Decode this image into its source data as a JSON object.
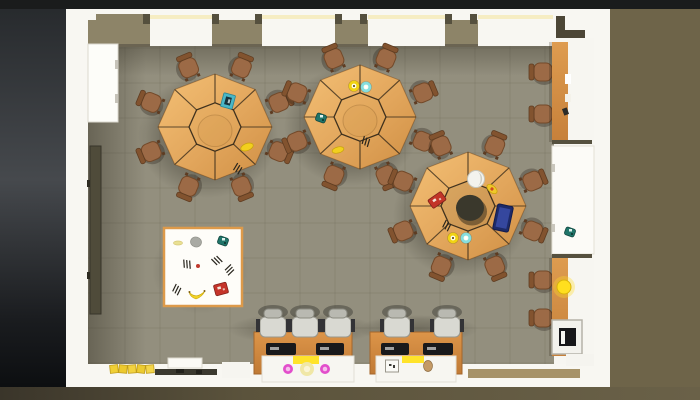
{
  "scene": {
    "canvas": {
      "w": 700,
      "h": 400
    },
    "chairAngles": [
      22.5,
      67.5,
      112.5,
      157.5,
      202.5,
      247.5,
      292.5,
      337.5
    ],
    "bg": [
      {
        "t": "rect",
        "n": "outside-ground-right",
        "x": 0,
        "y": 0,
        "w": 700,
        "h": 400,
        "f": "#6e6449"
      },
      {
        "t": "rect",
        "n": "outside-shadow-left",
        "x": 0,
        "y": 0,
        "w": 66,
        "h": 400,
        "f": "g:left"
      },
      {
        "t": "rect",
        "n": "top-dark-band",
        "x": 0,
        "y": 0,
        "w": 700,
        "h": 9,
        "f": "#1a1c1c"
      },
      {
        "t": "rect",
        "n": "bottom-ground-band",
        "x": 0,
        "y": 387,
        "w": 700,
        "h": 13,
        "f": "g:bottom"
      }
    ],
    "room": [
      {
        "t": "rect",
        "n": "room-walls",
        "x": 66,
        "y": 9,
        "w": 544,
        "h": 378,
        "f": "#f8f7f2"
      },
      {
        "t": "rect",
        "n": "floor",
        "x": 88,
        "y": 46,
        "w": 466,
        "h": 318,
        "f": "#938f7e"
      },
      {
        "t": "rect",
        "n": "right-worktop",
        "x": 554,
        "y": 38,
        "w": 40,
        "h": 326,
        "f": "#f7f6f1"
      }
    ],
    "grid": {
      "xs": [
        125,
        160,
        195,
        230,
        265,
        300,
        335,
        370,
        405,
        440,
        475,
        510,
        545
      ],
      "ys": [
        48,
        83,
        118,
        153,
        188,
        223,
        258,
        293,
        328,
        363
      ],
      "x0": 88,
      "x1": 554,
      "y0": 46,
      "y1": 364,
      "stroke": "#7e7a6a",
      "op": 0.5
    },
    "shadows": [
      {
        "t": "rect",
        "n": "floor-shadow-left",
        "x": 88,
        "y": 46,
        "w": 58,
        "h": 318,
        "f": "g:leftShadow"
      },
      {
        "t": "rect",
        "n": "floor-shadow-top",
        "x": 88,
        "y": 46,
        "w": 466,
        "h": 30,
        "f": "g:topShadow"
      },
      {
        "t": "ell",
        "n": "table-shadow",
        "x": 208,
        "y": 136,
        "rx": 70,
        "ry": 62,
        "f": "g:rad"
      },
      {
        "t": "ell",
        "n": "table-shadow",
        "x": 352,
        "y": 126,
        "rx": 68,
        "ry": 60,
        "f": "g:rad"
      },
      {
        "t": "ell",
        "n": "table-shadow",
        "x": 461,
        "y": 215,
        "rx": 68,
        "ry": 62,
        "f": "g:rad"
      },
      {
        "t": "ell",
        "n": "mat-shadow",
        "x": 200,
        "y": 270,
        "rx": 48,
        "ry": 44,
        "f": "g:rad",
        "op": 0.5
      },
      {
        "t": "ell",
        "n": "desk-shadow",
        "x": 302,
        "y": 329,
        "rx": 74,
        "ry": 16,
        "f": "g:rad",
        "op": 0.6
      },
      {
        "t": "ell",
        "n": "desk-shadow",
        "x": 418,
        "y": 329,
        "rx": 60,
        "ry": 14,
        "f": "g:rad",
        "op": 0.6
      }
    ],
    "topWall": {
      "sunColor": "#f6edc3",
      "chunkColor": "#8d8468",
      "edgeColor": "#6b6452",
      "notchColor": "#55503e",
      "cornerColor": "#4c4636",
      "windows": [
        {
          "x": 150,
          "w": 62
        },
        {
          "x": 262,
          "w": 73
        },
        {
          "x": 368,
          "w": 77
        },
        {
          "x": 478,
          "w": 75
        }
      ],
      "chunks": [
        {
          "x": 88,
          "w": 62
        },
        {
          "x": 212,
          "w": 50
        },
        {
          "x": 335,
          "w": 33
        },
        {
          "x": 445,
          "w": 33
        }
      ],
      "notches": [
        143,
        212,
        255,
        335,
        360,
        445,
        470
      ],
      "step": {
        "x": 96,
        "w": 47
      },
      "corner": [
        {
          "x": 556,
          "y": 16,
          "w": 9,
          "h": 22
        },
        {
          "x": 565,
          "y": 30,
          "w": 20,
          "h": 8
        }
      ]
    },
    "leftFixtures": [
      {
        "t": "rect",
        "n": "left-cabinet",
        "x": 88,
        "y": 44,
        "w": 30,
        "h": 78,
        "f": "#fdfdf9",
        "s": "#dcd9cf",
        "sw": 1
      },
      {
        "t": "rect",
        "n": "cabinet-handle",
        "x": 115,
        "y": 60,
        "w": 3,
        "h": 9,
        "f": "#c6c3b9"
      },
      {
        "t": "rect",
        "n": "cabinet-handle",
        "x": 115,
        "y": 94,
        "w": 3,
        "h": 9,
        "f": "#c6c3b9"
      },
      {
        "t": "rect",
        "n": "wall-board",
        "x": 90,
        "y": 146,
        "w": 11,
        "h": 168,
        "f": "#4f4b3a",
        "s": "#37342a",
        "sw": 1
      },
      {
        "t": "rect",
        "n": "board-bracket",
        "x": 87,
        "y": 180,
        "w": 3,
        "h": 7,
        "f": "#2e2c22"
      },
      {
        "t": "rect",
        "n": "board-bracket",
        "x": 87,
        "y": 272,
        "w": 3,
        "h": 7,
        "f": "#2e2c22"
      }
    ],
    "rightFixtures": [
      {
        "t": "rect",
        "n": "counter-edge-shadow",
        "x": 549,
        "y": 42,
        "w": 4,
        "h": 100,
        "f": "rgba(40,30,15,0.22)"
      },
      {
        "t": "rect",
        "n": "wood-counter-top",
        "x": 552,
        "y": 42,
        "w": 16,
        "h": 100,
        "f": "g:woodv"
      },
      {
        "t": "rect",
        "n": "counter-paper",
        "x": 565,
        "y": 74,
        "w": 6,
        "h": 10,
        "f": "#ffffff"
      },
      {
        "t": "rect",
        "n": "counter-paper",
        "x": 565,
        "y": 94,
        "w": 6,
        "h": 8,
        "f": "#f4f2ea"
      },
      {
        "t": "rect",
        "n": "counter-mouse",
        "x": 563,
        "y": 108,
        "w": 5,
        "h": 7,
        "f": "#2b2b28",
        "rot": -20
      },
      {
        "t": "rect",
        "n": "counter-divider",
        "x": 552,
        "y": 140,
        "w": 40,
        "h": 4,
        "f": "#56513f"
      },
      {
        "t": "rect",
        "n": "white-side-table",
        "x": 552,
        "y": 146,
        "w": 42,
        "h": 108,
        "f": "#fcfbf7",
        "s": "#e3e0d6",
        "sw": 1
      },
      {
        "t": "rect",
        "n": "side-table-handle",
        "x": 552,
        "y": 164,
        "w": 3,
        "h": 8,
        "f": "#c9c6bc"
      },
      {
        "t": "rect",
        "n": "side-table-handle",
        "x": 552,
        "y": 224,
        "w": 3,
        "h": 8,
        "f": "#c9c6bc"
      },
      {
        "t": "rect",
        "n": "counter-divider",
        "x": 552,
        "y": 254,
        "w": 40,
        "h": 4,
        "f": "#56513f"
      },
      {
        "t": "rect",
        "n": "counter-edge-shadow",
        "x": 549,
        "y": 258,
        "w": 4,
        "h": 98,
        "f": "rgba(40,30,15,0.22)"
      },
      {
        "t": "rect",
        "n": "wood-counter-bottom",
        "x": 552,
        "y": 258,
        "w": 16,
        "h": 98,
        "f": "g:woodv"
      },
      {
        "t": "circ",
        "n": "lamp-glow",
        "x": 564,
        "y": 287,
        "r": 11,
        "f": "rgba(255,222,40,0.35)"
      },
      {
        "t": "circ",
        "n": "desk-lamp",
        "x": 564,
        "y": 287,
        "r": 7,
        "f": "#ffdf1e",
        "s": "#d9b40a",
        "sw": 1
      },
      {
        "t": "rect",
        "n": "printer-body",
        "x": 552,
        "y": 320,
        "w": 30,
        "h": 34,
        "f": "#f3f2ed",
        "s": "#b5b2a8",
        "sw": 1.5
      },
      {
        "t": "rect",
        "n": "printer-screen",
        "x": 559,
        "y": 328,
        "w": 17,
        "h": 18,
        "f": "#17171a"
      },
      {
        "t": "rect",
        "n": "printer-slot",
        "x": 561,
        "y": 331,
        "w": 4,
        "h": 13,
        "f": "#f6f6f2"
      },
      {
        "t": "rect",
        "n": "corner-shelf",
        "x": 566,
        "y": 354,
        "w": 28,
        "h": 12,
        "f": "#f5f4ef"
      }
    ],
    "rightItems": [
      {
        "type": "clump",
        "x": 570,
        "y": 232
      }
    ],
    "mat": {
      "x": 164,
      "y": 228,
      "w": 78,
      "h": 78,
      "fill": "#fefdf9",
      "border": "#dd9a4a",
      "items": [
        {
          "type": "blob",
          "x": 178,
          "y": 243,
          "w": 9,
          "h": 4,
          "rot": 0,
          "f": "#e9e093",
          "s": "#d6c877"
        },
        {
          "type": "blob",
          "x": 196,
          "y": 242,
          "w": 11,
          "h": 10,
          "rot": 15,
          "f": "#a9aaa4",
          "s": "#8f9089"
        },
        {
          "type": "clump",
          "x": 223,
          "y": 241
        },
        {
          "type": "dot",
          "x": 198,
          "y": 266,
          "r": 2,
          "f": "#c03a2e"
        },
        {
          "type": "marks",
          "x": 176,
          "y": 289,
          "rot": 40
        },
        {
          "type": "marks",
          "x": 186,
          "y": 264,
          "rot": 10
        },
        {
          "type": "marks",
          "x": 216,
          "y": 261,
          "rot": -30
        },
        {
          "type": "marks",
          "x": 229,
          "y": 269,
          "rot": 60
        },
        {
          "type": "banana",
          "x": 197,
          "y": 291
        },
        {
          "type": "box",
          "x": 221,
          "y": 289,
          "w": 13,
          "h": 11,
          "rot": -15,
          "f": "#c5342a"
        }
      ]
    },
    "tables": [
      {
        "name": "octagon-table-1",
        "cx": 215,
        "cy": 127,
        "r": 57,
        "ir": 26,
        "hole": false,
        "items": [
          {
            "type": "book",
            "x": 228,
            "y": 101,
            "rot": 15
          },
          {
            "type": "blob",
            "x": 247,
            "y": 147,
            "w": 13,
            "h": 7,
            "rot": -20,
            "f": "#f2cf1e",
            "s": "#c7a30a"
          },
          {
            "type": "marks",
            "x": 237,
            "y": 168,
            "rot": 45
          }
        ]
      },
      {
        "name": "octagon-table-2",
        "cx": 360,
        "cy": 117,
        "r": 56,
        "ir": 26,
        "hole": false,
        "items": [
          {
            "type": "donut",
            "x": 354,
            "y": 86,
            "ring": "#f2d313",
            "dotc": "#6b5a12"
          },
          {
            "type": "donut",
            "x": 366,
            "y": 87,
            "ring": "#86dede",
            "dotc": "#ffffff"
          },
          {
            "type": "clump",
            "x": 321,
            "y": 118
          },
          {
            "type": "blob",
            "x": 338,
            "y": 150,
            "w": 12,
            "h": 6,
            "rot": -15,
            "f": "#f2cf1e",
            "s": "#c7a30a"
          },
          {
            "type": "marks",
            "x": 365,
            "y": 141,
            "rot": 30
          }
        ]
      },
      {
        "name": "octagon-donut-table",
        "cx": 468,
        "cy": 206,
        "r": 58,
        "ir": 27,
        "hole": true,
        "items": [
          {
            "type": "globe",
            "x": 476,
            "y": 179
          },
          {
            "type": "blob",
            "x": 492,
            "y": 189,
            "w": 12,
            "h": 7,
            "rot": 40,
            "f": "#f0c82a",
            "s": "#c7a30a",
            "dotc": "#d04a20"
          },
          {
            "type": "box",
            "x": 437,
            "y": 200,
            "w": 16,
            "h": 10,
            "rot": -35,
            "f": "#c23428"
          },
          {
            "type": "tablet",
            "x": 503,
            "y": 218,
            "rot": 12
          },
          {
            "type": "marks",
            "x": 446,
            "y": 225,
            "rot": 40
          },
          {
            "type": "donut",
            "x": 453,
            "y": 238,
            "ring": "#f2d313",
            "dotc": "#6b5a12"
          },
          {
            "type": "donut",
            "x": 466,
            "y": 238,
            "ring": "#86dede",
            "dotc": "#ffffff"
          }
        ]
      }
    ],
    "extraChairs": [
      {
        "x": 543,
        "y": 72,
        "deg": 0
      },
      {
        "x": 543,
        "y": 114,
        "deg": 0
      },
      {
        "x": 543,
        "y": 280,
        "deg": 0
      },
      {
        "x": 543,
        "y": 318,
        "deg": 0
      }
    ],
    "desks": [
      {
        "n": "computer-desk",
        "x": 254,
        "y": 332,
        "w": 98,
        "h": 42
      },
      {
        "n": "computer-desk",
        "x": 370,
        "y": 332,
        "w": 92,
        "h": 42
      }
    ],
    "monitors": [
      {
        "x": 266,
        "y": 343,
        "w": 30,
        "h": 12
      },
      {
        "x": 316,
        "y": 343,
        "w": 28,
        "h": 12
      },
      {
        "x": 381,
        "y": 343,
        "w": 28,
        "h": 12
      },
      {
        "x": 423,
        "y": 343,
        "w": 30,
        "h": 12
      }
    ],
    "officeChairs": [
      {
        "x": 273,
        "y": 326
      },
      {
        "x": 305,
        "y": 326
      },
      {
        "x": 338,
        "y": 326
      },
      {
        "x": 397,
        "y": 326
      },
      {
        "x": 447,
        "y": 326
      }
    ],
    "counters": [
      {
        "x": 262,
        "y": 356,
        "w": 92,
        "h": 26,
        "items": [
          {
            "type": "strip",
            "x": 293,
            "y": 356,
            "w": 26,
            "h": 8,
            "f": "#ffe32a"
          },
          {
            "type": "dot",
            "x": 288,
            "y": 369,
            "r": 5,
            "f": "#e24ecb",
            "inner": "#f6bfec"
          },
          {
            "type": "dot",
            "x": 307,
            "y": 369,
            "r": 7,
            "f": "#f0e7a6",
            "inner": "#faf5d6"
          },
          {
            "type": "dot",
            "x": 325,
            "y": 369,
            "r": 5,
            "f": "#e24ecb",
            "inner": "#f6bfec"
          }
        ]
      },
      {
        "x": 376,
        "y": 356,
        "w": 80,
        "h": 26,
        "items": [
          {
            "type": "strip",
            "x": 402,
            "y": 356,
            "w": 22,
            "h": 7,
            "f": "#ffe32a"
          },
          {
            "type": "cube",
            "x": 392,
            "y": 366,
            "w": 13,
            "h": 12
          },
          {
            "type": "blob",
            "x": 428,
            "y": 366,
            "w": 9,
            "h": 11,
            "rot": 0,
            "f": "#c49a66",
            "s": "#8f6d42"
          }
        ]
      }
    ],
    "deskDebris": [
      {
        "t": "ell",
        "n": "chair-base",
        "x": 340,
        "y": 371,
        "rx": 7,
        "ry": 4,
        "f": "#3b3b38",
        "rot": -30
      },
      {
        "t": "ell",
        "n": "chair-base",
        "x": 433,
        "y": 370,
        "rx": 6,
        "ry": 4,
        "f": "#3b3b38",
        "rot": 20
      }
    ],
    "bottomLeft": [
      {
        "t": "rect",
        "n": "yellow-book",
        "x": 110,
        "y": 365,
        "w": 8,
        "h": 8,
        "f": "#f0cf35",
        "s": "#bf9c1c",
        "sw": 0.8,
        "rot": -6
      },
      {
        "t": "rect",
        "n": "yellow-book",
        "x": 119,
        "y": 365,
        "w": 8,
        "h": 8,
        "f": "#edc92e",
        "s": "#bf9c1c",
        "sw": 0.8,
        "rot": 5
      },
      {
        "t": "rect",
        "n": "yellow-book",
        "x": 128,
        "y": 365,
        "w": 8,
        "h": 8,
        "f": "#f2d23f",
        "s": "#bf9c1c",
        "sw": 0.8,
        "rot": -4
      },
      {
        "t": "rect",
        "n": "yellow-book",
        "x": 137,
        "y": 365,
        "w": 8,
        "h": 8,
        "f": "#eccb31",
        "s": "#bf9c1c",
        "sw": 0.8,
        "rot": 7
      },
      {
        "t": "rect",
        "n": "yellow-book",
        "x": 146,
        "y": 365,
        "w": 8,
        "h": 8,
        "f": "#f4d64a",
        "s": "#bf9c1c",
        "sw": 0.8,
        "rot": -5
      },
      {
        "t": "rect",
        "n": "shelf-strip",
        "x": 155,
        "y": 369,
        "w": 62,
        "h": 6,
        "f": "#3b392f"
      },
      {
        "t": "rect",
        "n": "shelf-item",
        "x": 176,
        "y": 369,
        "w": 8,
        "h": 4,
        "f": "#23221c"
      },
      {
        "t": "rect",
        "n": "shelf-item",
        "x": 196,
        "y": 370,
        "w": 6,
        "h": 4,
        "f": "#23221c"
      },
      {
        "t": "rect",
        "n": "shelf-box",
        "x": 168,
        "y": 358,
        "w": 34,
        "h": 10,
        "f": "#fbfaf5",
        "s": "#dddacf",
        "sw": 1
      },
      {
        "t": "rect",
        "n": "wall-ledge",
        "x": 222,
        "y": 362,
        "w": 28,
        "h": 16,
        "f": "#f6f5f0"
      },
      {
        "t": "rect",
        "n": "entry-mat",
        "x": 468,
        "y": 369,
        "w": 112,
        "h": 9,
        "f": "#9c8659",
        "op": 0.9
      }
    ]
  }
}
